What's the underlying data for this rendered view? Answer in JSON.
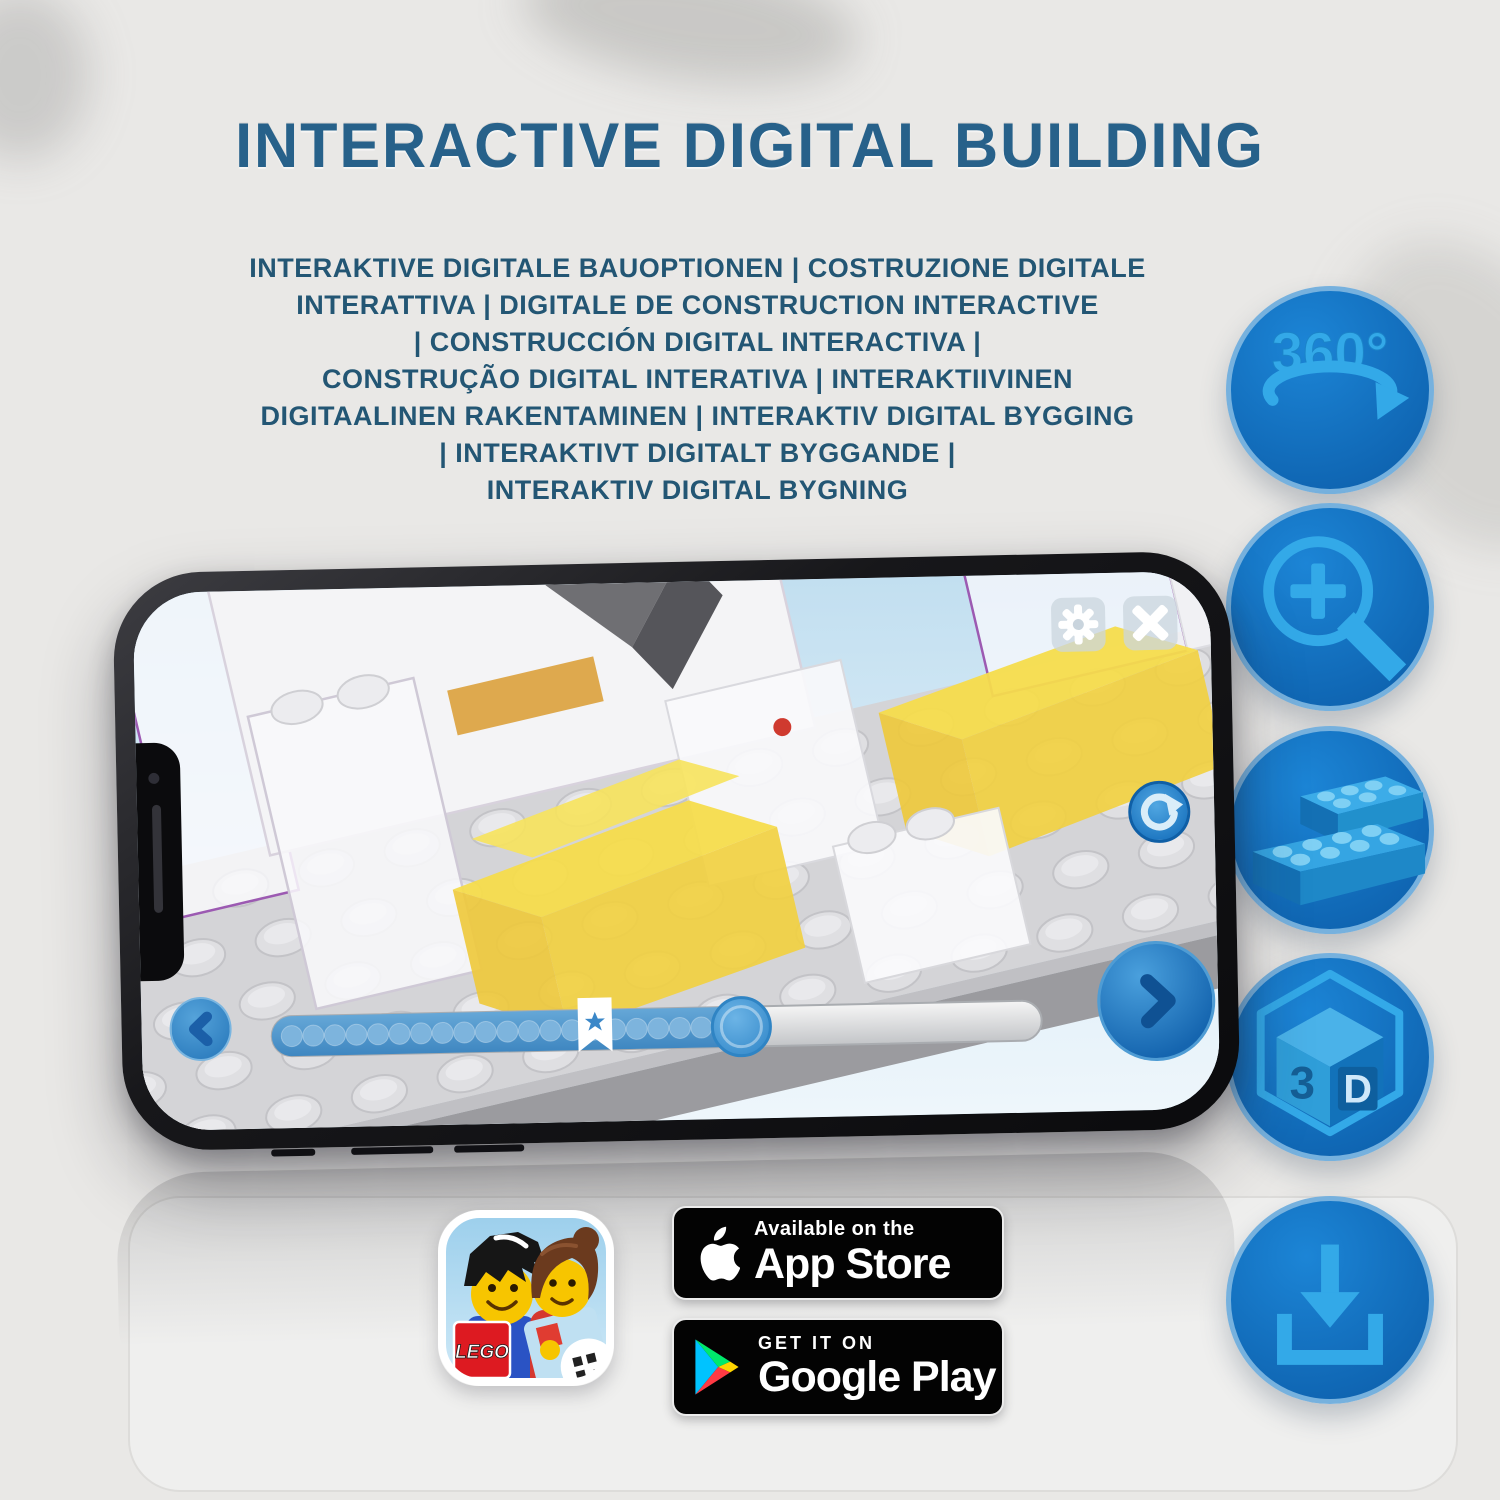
{
  "title": {
    "text": "INTERACTIVE DIGITAL BUILDING"
  },
  "subtitle": {
    "lines": [
      "INTERAKTIVE DIGITALE BAUOPTIONEN | COSTRUZIONE DIGITALE",
      "INTERATTIVA | DIGITALE DE CONSTRUCTION INTERACTIVE",
      "| CONSTRUCCIÓN DIGITAL INTERACTIVA |",
      "CONSTRUÇÃO DIGITAL INTERATIVA | INTERAKTIIVINEN",
      "DIGITAALINEN RAKENTAMINEN | INTERAKTIV DIGITAL BYGGING",
      "| INTERAKTIVT DIGITALT BYGGANDE |",
      "INTERAKTIV DIGITAL BYGNING"
    ]
  },
  "features": {
    "items": [
      {
        "name": "360-rotation-icon",
        "label": "360°"
      },
      {
        "name": "zoom-in-icon",
        "label": ""
      },
      {
        "name": "brick-steps-icon",
        "label": ""
      },
      {
        "name": "3d-view-icon",
        "label_3": "3",
        "label_d": "D"
      },
      {
        "name": "download-icon",
        "label": ""
      }
    ]
  },
  "phone": {
    "progress": {
      "dots_total": 20,
      "filled_percent": 61,
      "bookmark_percent": 42
    }
  },
  "store": {
    "app_icon_label": "LEGO",
    "app_store": {
      "line1": "Available on the",
      "line2": "App Store"
    },
    "google_play": {
      "line1": "GET IT ON",
      "line2": "Google Play"
    }
  },
  "colors": {
    "title": "#27618a",
    "subtitle": "#235674",
    "circle_fill": "#1173c5",
    "circle_glyph": "#33a9e8",
    "slider_fill": "#4f97cf",
    "brick_yellow": "#f3da4e"
  }
}
